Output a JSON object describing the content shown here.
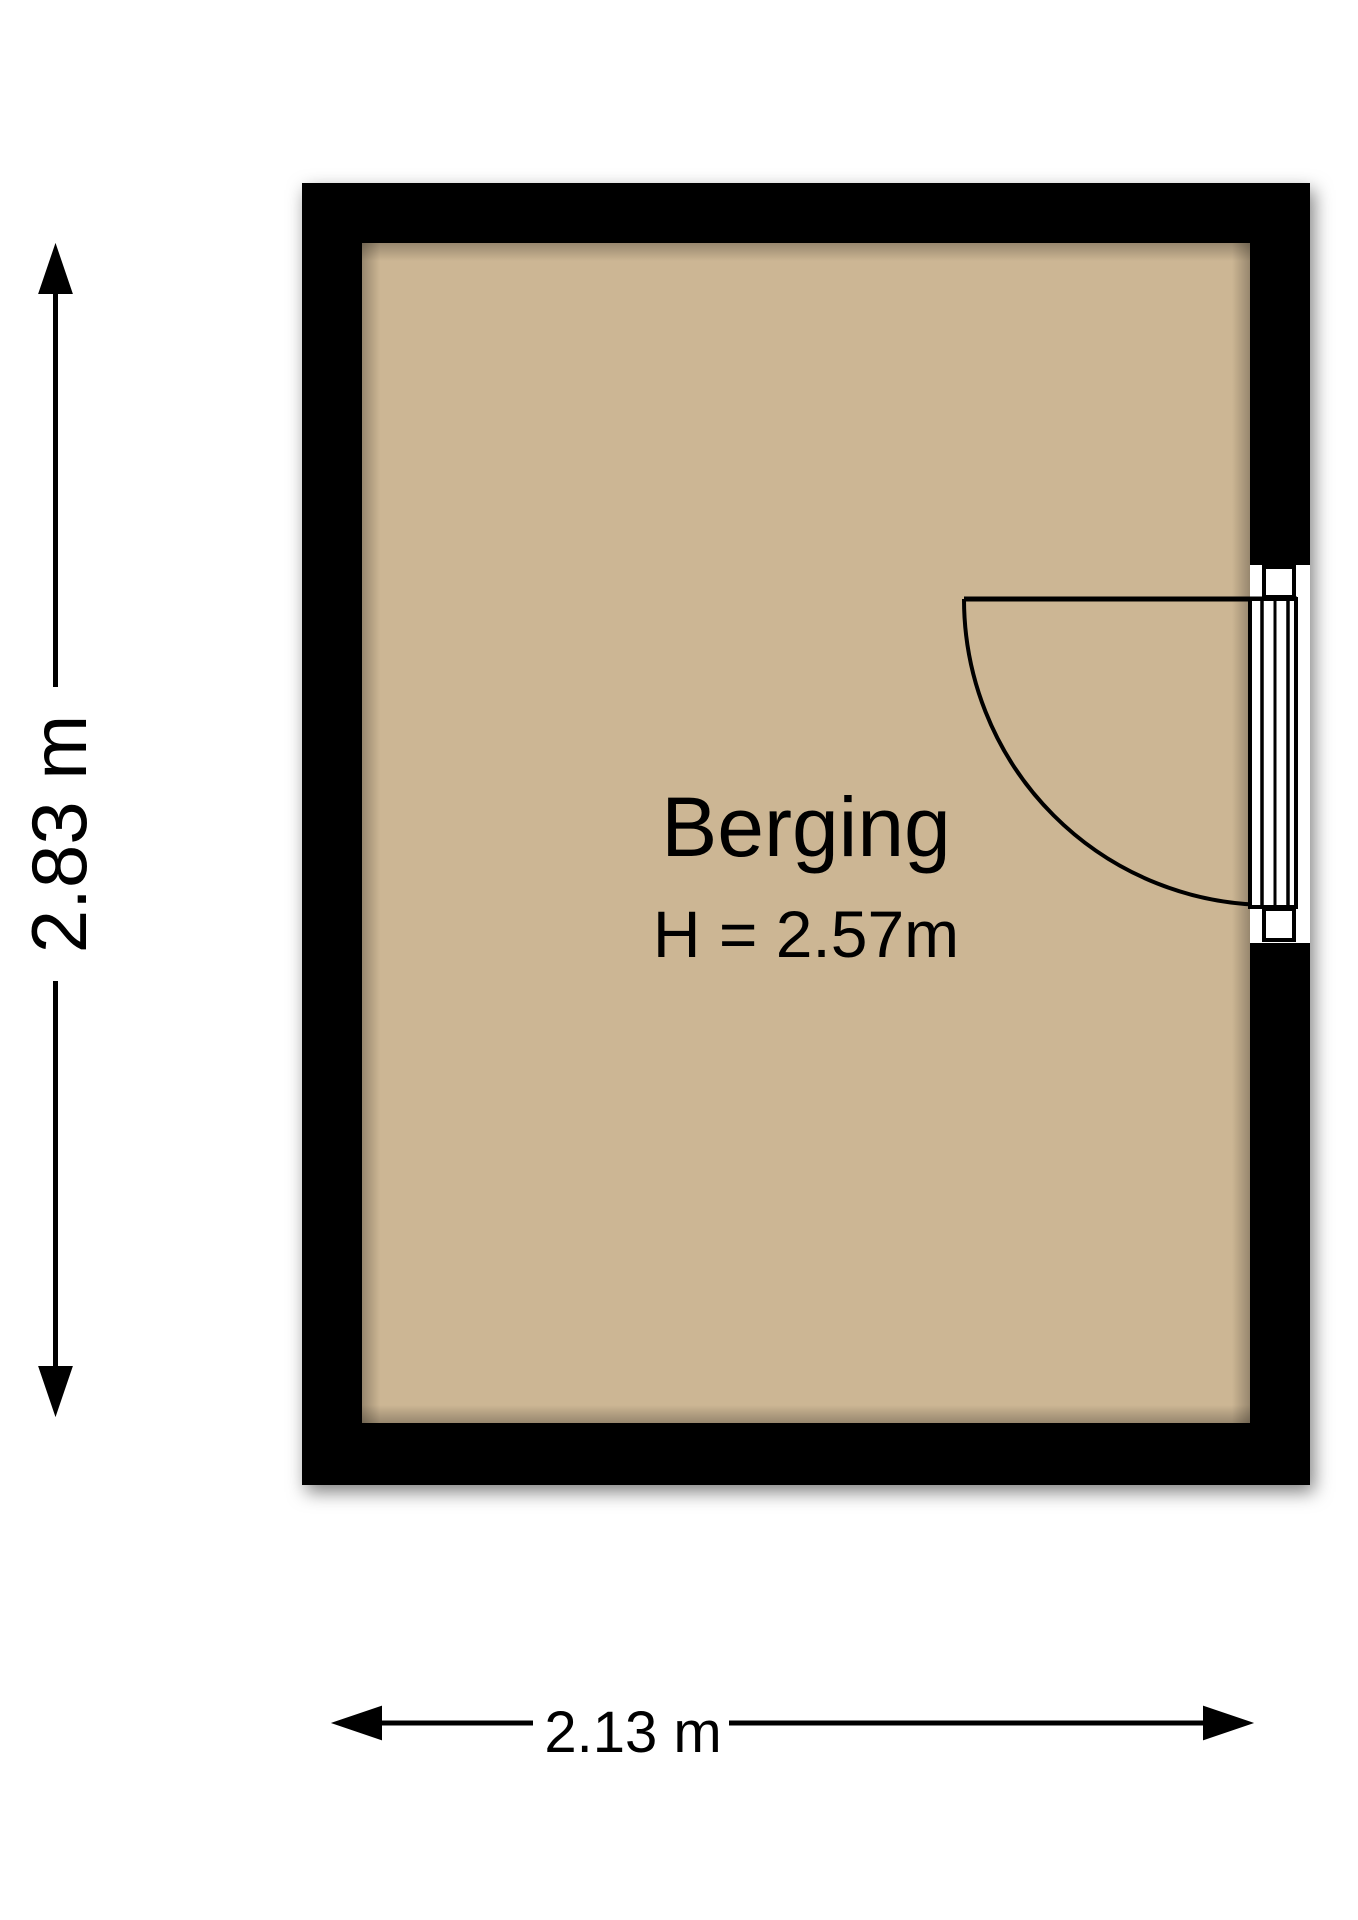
{
  "room": {
    "name": "Berging",
    "ceiling_height_label": "H = 2.57m"
  },
  "dimensions": {
    "height_label": "2.83 m",
    "width_label": "2.13 m"
  },
  "colors": {
    "wall": "#000000",
    "floor": "#ccb694",
    "door_opening": "#ffffff",
    "line": "#000000",
    "background": "#ffffff"
  }
}
